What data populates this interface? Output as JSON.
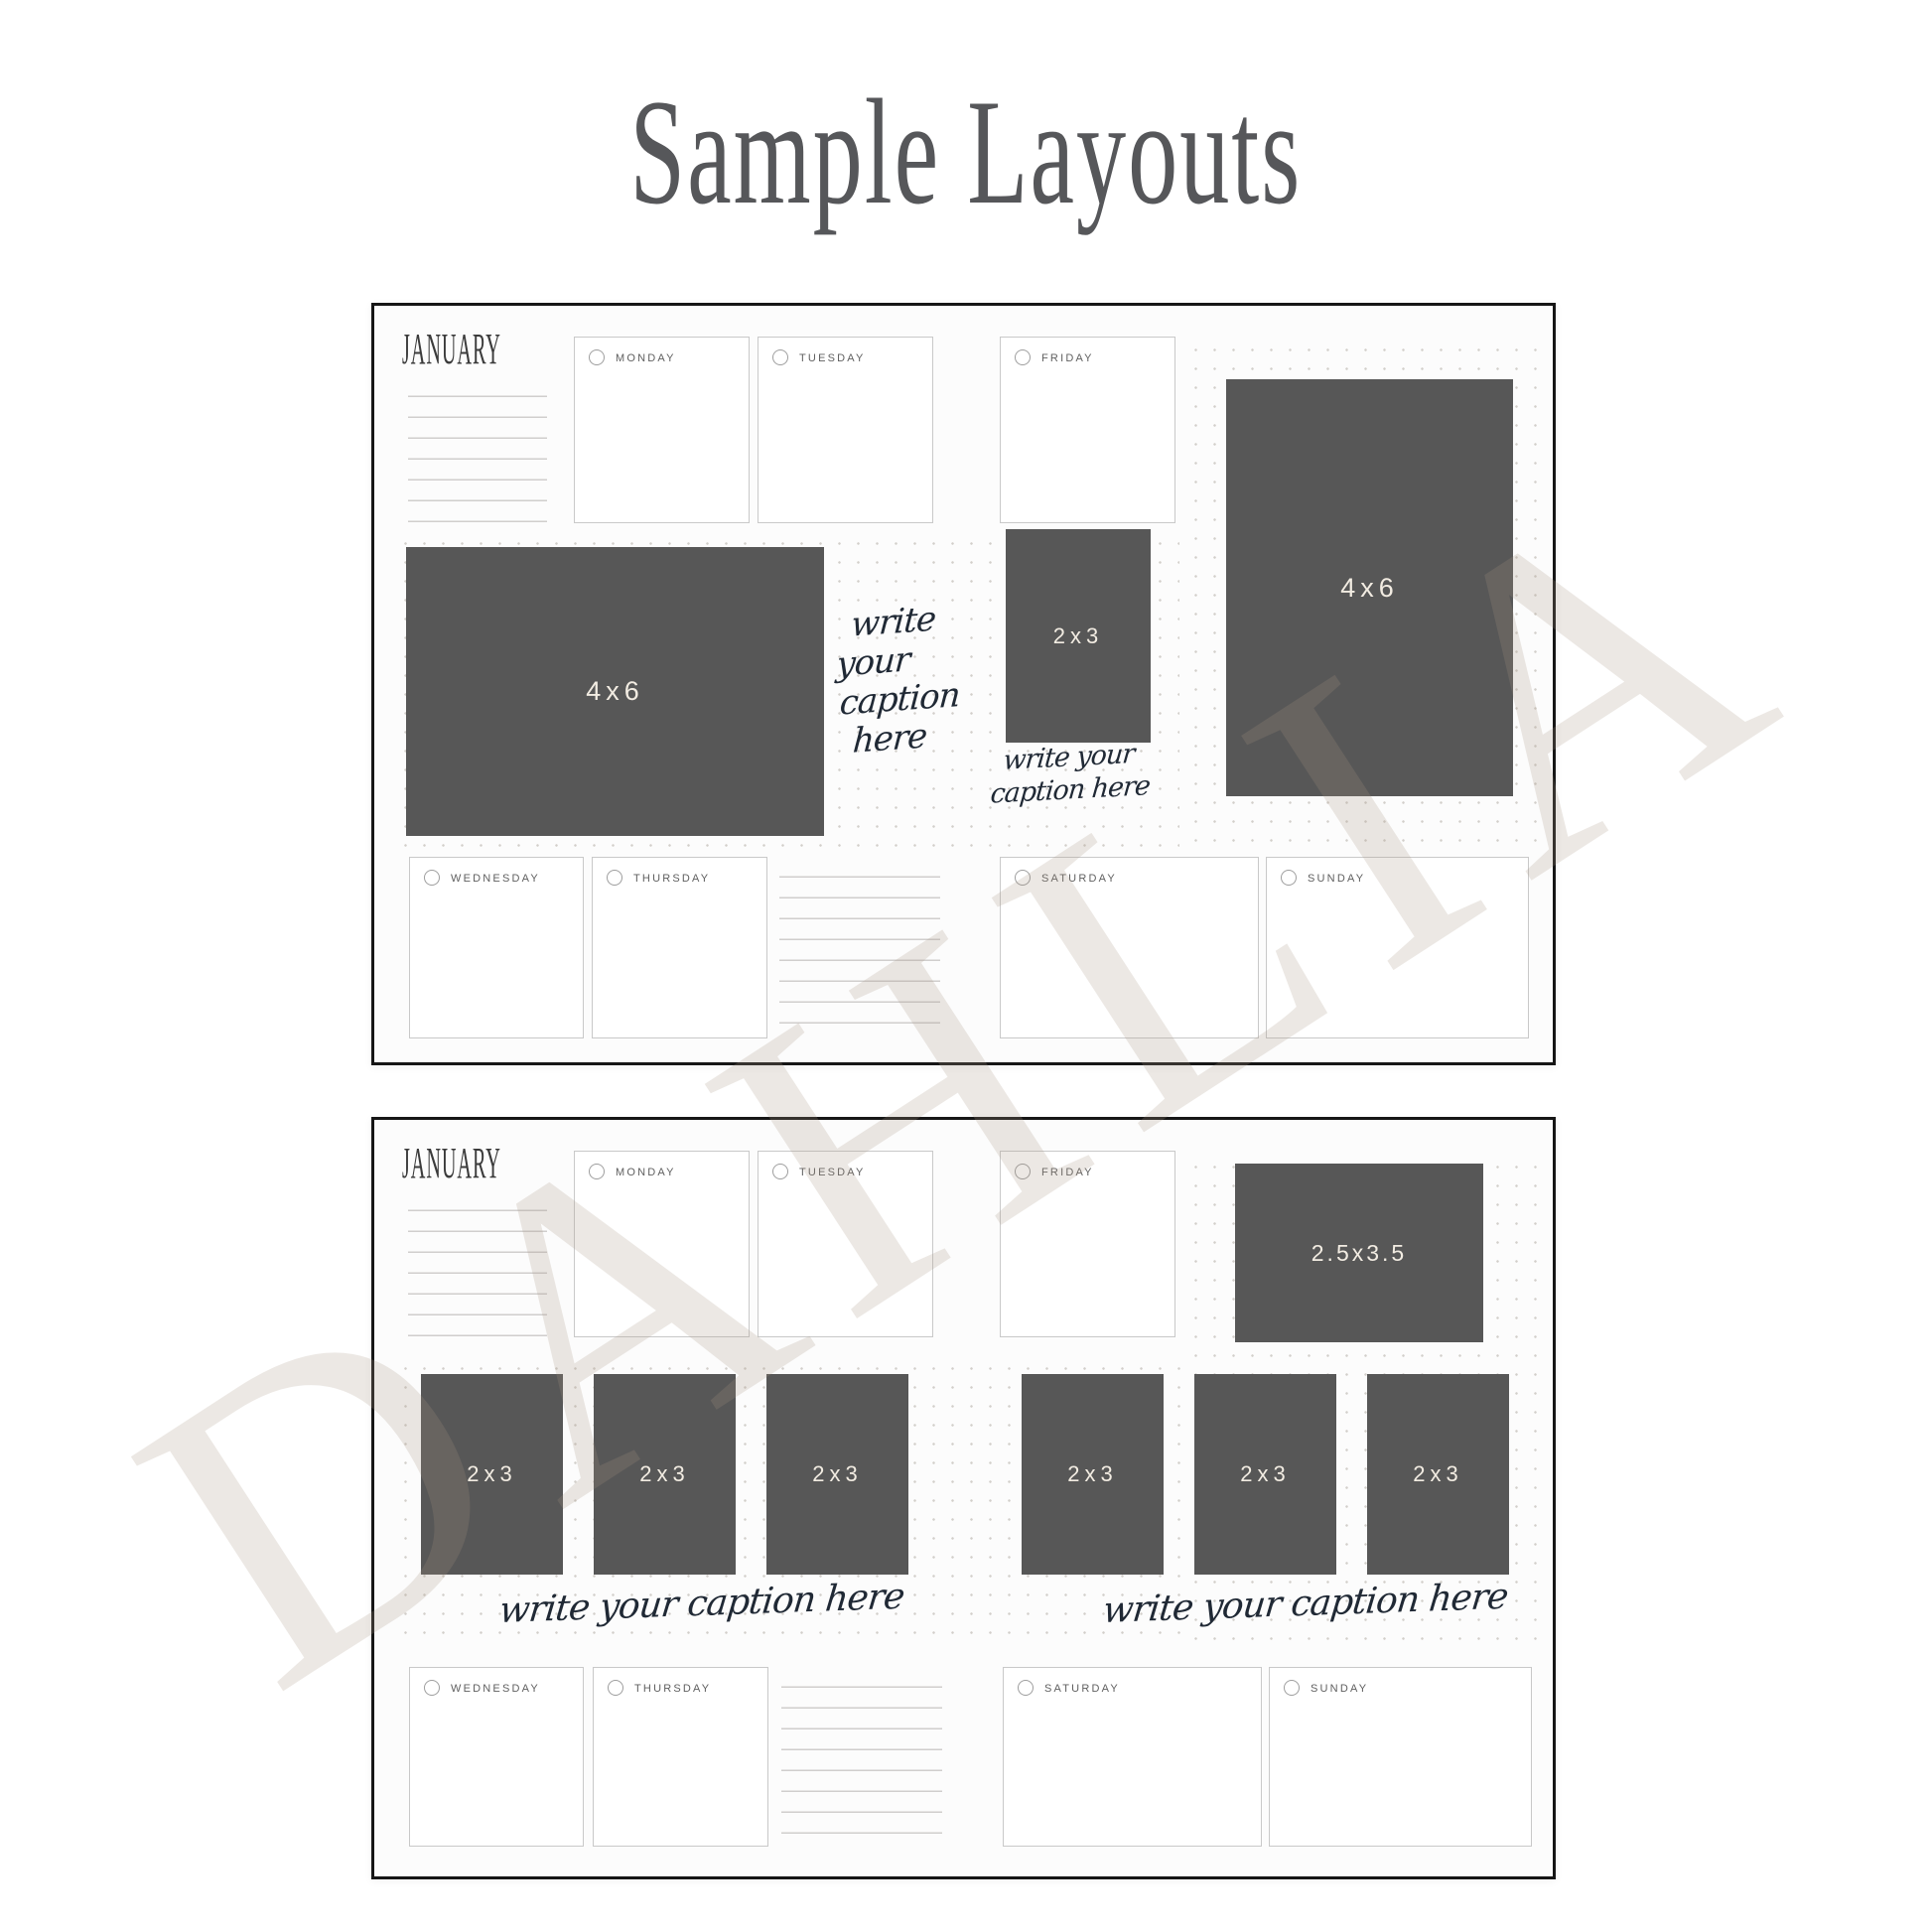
{
  "page_title": "Sample Layouts",
  "watermark": "DAHLIA",
  "colors": {
    "photo_placeholder": "#575757",
    "panel_border": "#161616",
    "script_ink": "#202935",
    "day_label": "#5f5f5f",
    "dot_grid": "#d2cfca"
  },
  "panels": [
    {
      "month": "JANUARY",
      "top_day_boxes": [
        {
          "label": "MONDAY"
        },
        {
          "label": "TUESDAY"
        },
        {
          "label": "FRIDAY"
        }
      ],
      "bottom_day_boxes": [
        {
          "label": "WEDNESDAY"
        },
        {
          "label": "THURSDAY"
        },
        {
          "label": "SATURDAY"
        },
        {
          "label": "SUNDAY"
        }
      ],
      "photos": [
        {
          "label": "4x6",
          "orientation": "landscape"
        },
        {
          "label": "2x3",
          "orientation": "portrait"
        },
        {
          "label": "4x6",
          "orientation": "portrait"
        }
      ],
      "caption_stack": [
        "write",
        "your",
        "caption",
        "here"
      ],
      "caption_pair": [
        "write your",
        "caption here"
      ]
    },
    {
      "month": "JANUARY",
      "top_day_boxes": [
        {
          "label": "MONDAY"
        },
        {
          "label": "TUESDAY"
        },
        {
          "label": "FRIDAY"
        }
      ],
      "bottom_day_boxes": [
        {
          "label": "WEDNESDAY"
        },
        {
          "label": "THURSDAY"
        },
        {
          "label": "SATURDAY"
        },
        {
          "label": "SUNDAY"
        }
      ],
      "photos": [
        {
          "label": "2.5x3.5",
          "orientation": "landscape"
        },
        {
          "label": "2x3",
          "orientation": "portrait"
        },
        {
          "label": "2x3",
          "orientation": "portrait"
        },
        {
          "label": "2x3",
          "orientation": "portrait"
        },
        {
          "label": "2x3",
          "orientation": "portrait"
        },
        {
          "label": "2x3",
          "orientation": "portrait"
        },
        {
          "label": "2x3",
          "orientation": "portrait"
        }
      ],
      "captions": [
        "write your caption here",
        "write your caption here"
      ]
    }
  ]
}
